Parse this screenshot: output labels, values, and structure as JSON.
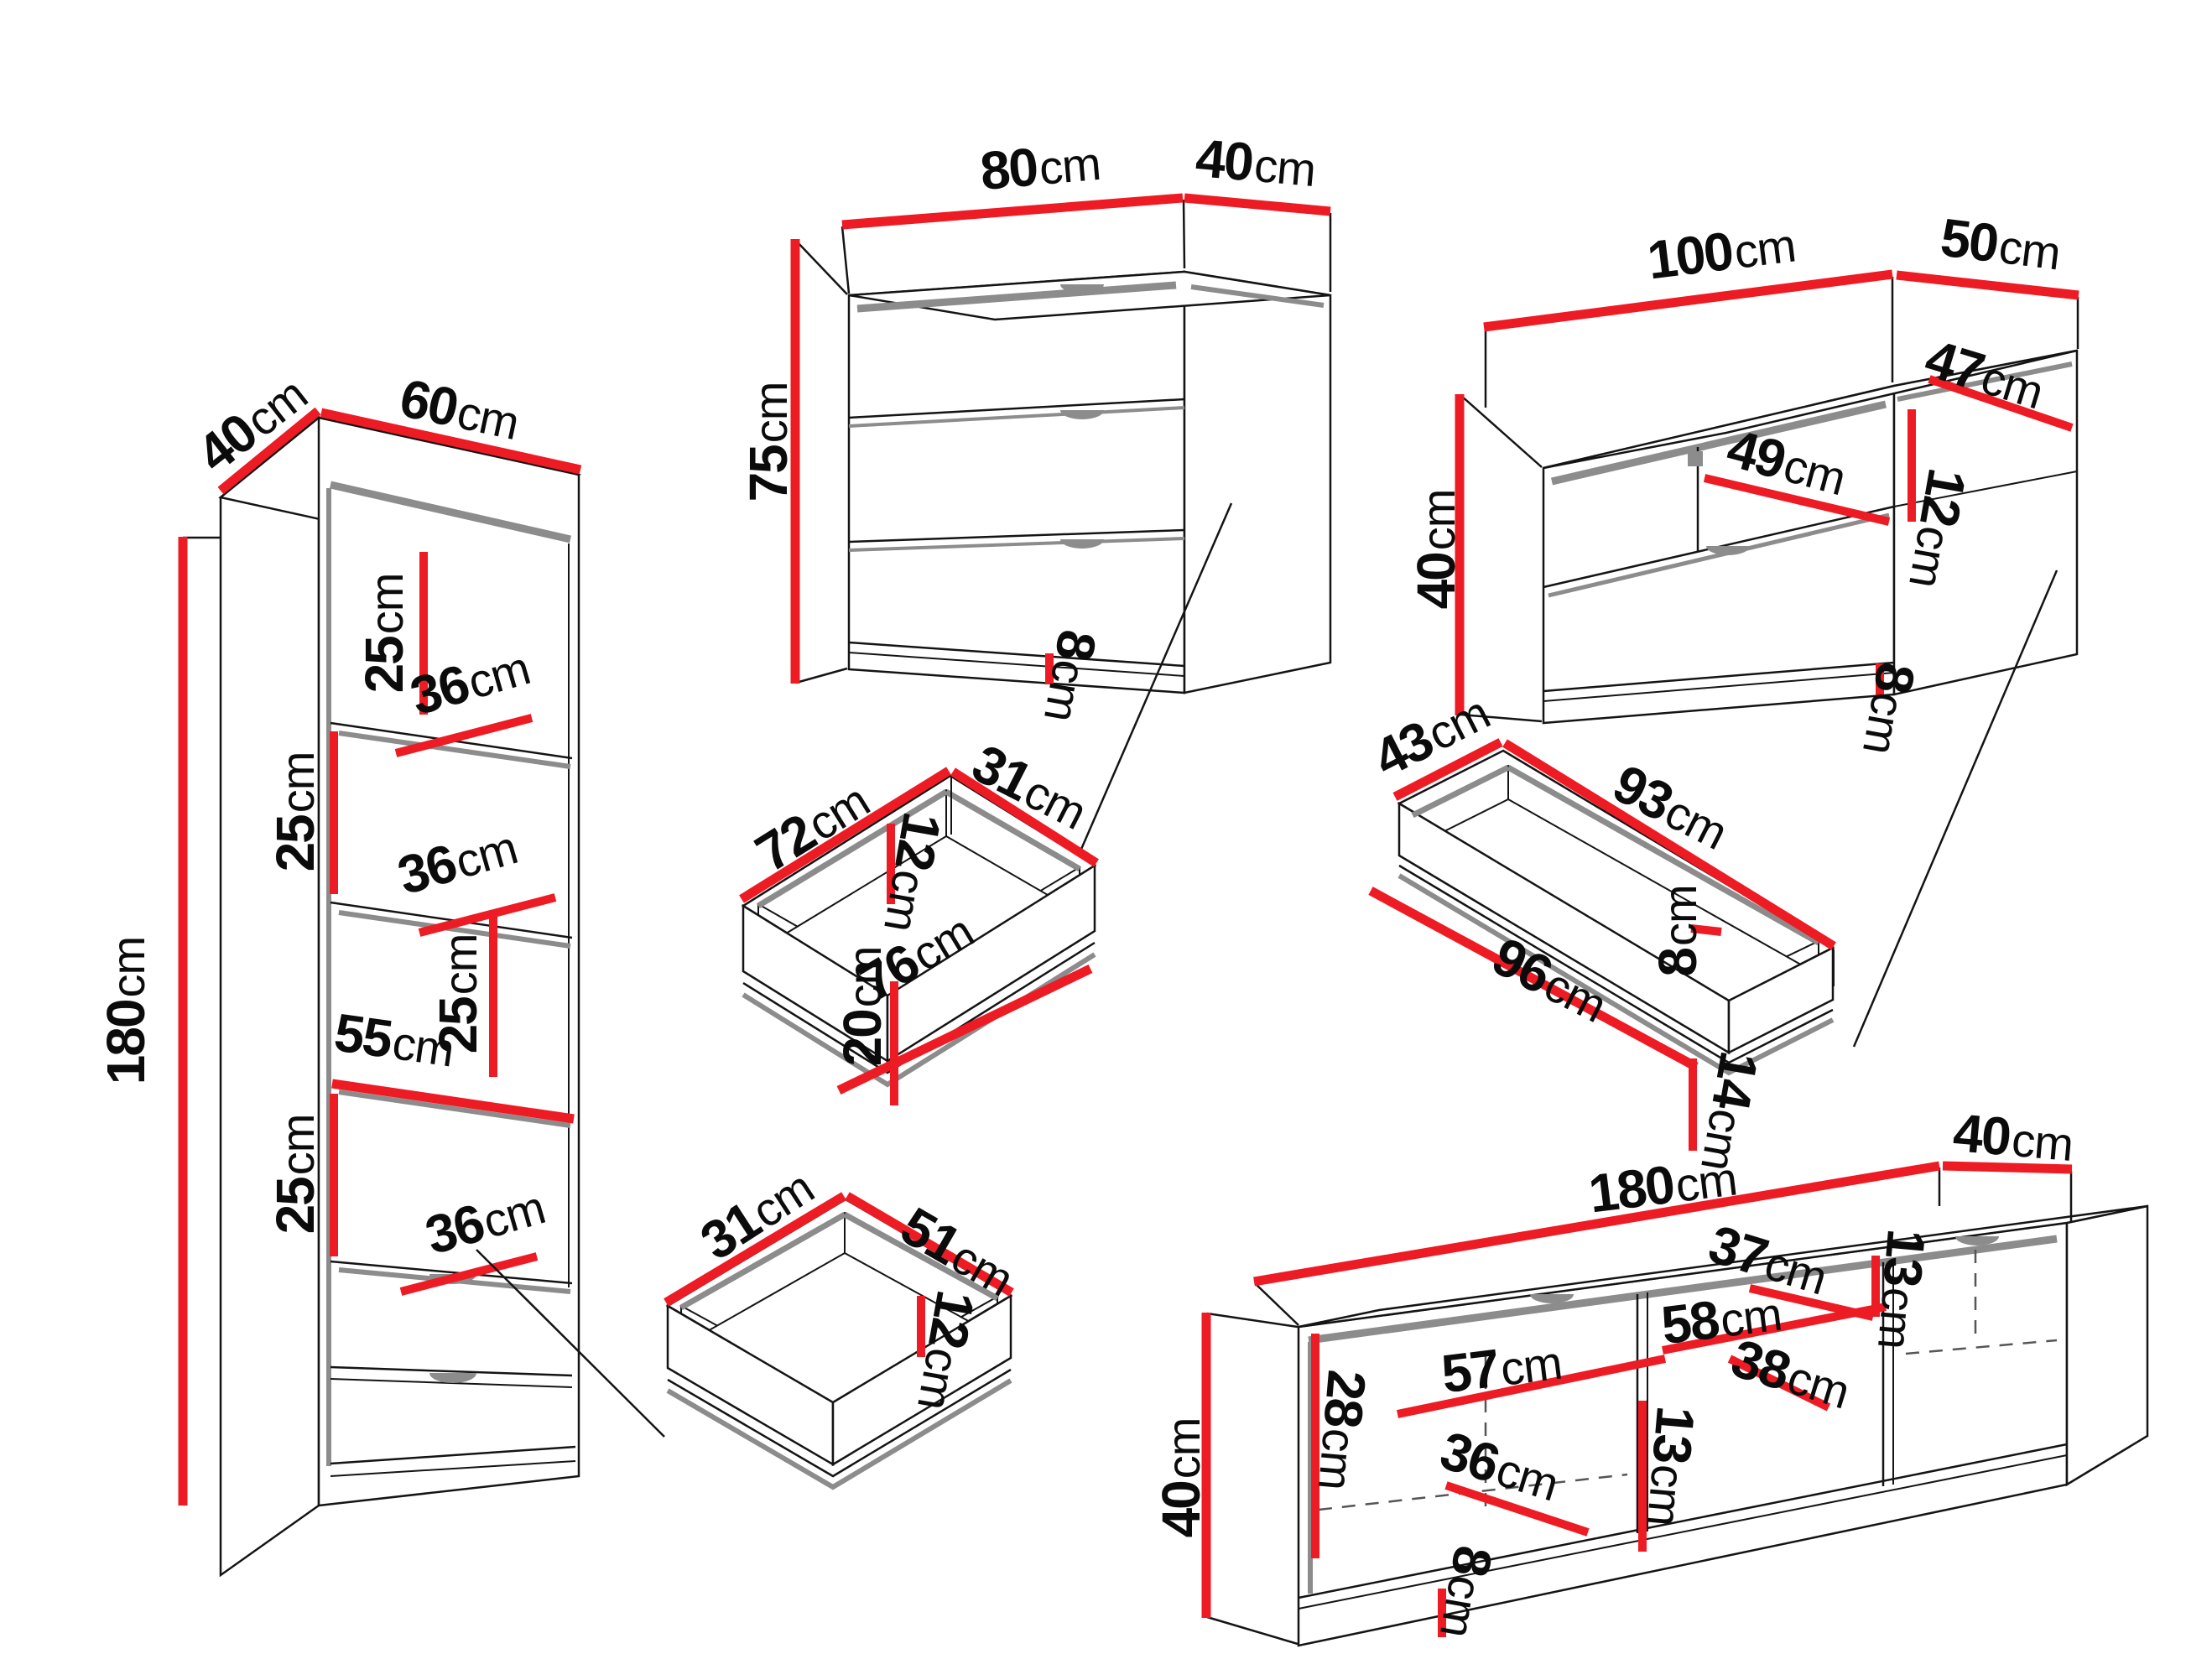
{
  "diagram_title": "Furniture dimensions diagram",
  "units": "cm",
  "colors": {
    "dimension_red": "#ed1c24",
    "shadow_gray": "#8c8c8c",
    "outline_black": "#141414",
    "background": "#ffffff"
  },
  "pieces": {
    "bookcase": {
      "name": "tall bookcase with drawers",
      "labels": {
        "depth": {
          "num": "40",
          "unit": "cm"
        },
        "width": {
          "num": "60",
          "unit": "cm"
        },
        "height": {
          "num": "180",
          "unit": "cm"
        },
        "c1": {
          "num": "25",
          "unit": "cm"
        },
        "s1": {
          "num": "36",
          "unit": "cm"
        },
        "c2": {
          "num": "25",
          "unit": "cm"
        },
        "s2": {
          "num": "36",
          "unit": "cm"
        },
        "c3": {
          "num": "25",
          "unit": "cm"
        },
        "shelf_width": {
          "num": "55",
          "unit": "cm"
        },
        "c4": {
          "num": "25",
          "unit": "cm"
        },
        "s3": {
          "num": "36",
          "unit": "cm"
        }
      }
    },
    "chest": {
      "name": "chest of drawers",
      "labels": {
        "width": {
          "num": "80",
          "unit": "cm"
        },
        "depth": {
          "num": "40",
          "unit": "cm"
        },
        "height": {
          "num": "75",
          "unit": "cm"
        },
        "plinth": {
          "num": "8",
          "unit": "cm"
        }
      }
    },
    "drawer_chest": {
      "name": "chest drawer box",
      "labels": {
        "width": {
          "num": "72",
          "unit": "cm"
        },
        "depth": {
          "num": "31",
          "unit": "cm"
        },
        "inner_height": {
          "num": "12",
          "unit": "cm"
        },
        "front_width": {
          "num": "76",
          "unit": "cm"
        },
        "front_height": {
          "num": "20",
          "unit": "cm"
        }
      }
    },
    "tv_small": {
      "name": "TV cabinet 100",
      "labels": {
        "width": {
          "num": "100",
          "unit": "cm"
        },
        "depth": {
          "num": "50",
          "unit": "cm"
        },
        "height": {
          "num": "40",
          "unit": "cm"
        },
        "shelf_depth": {
          "num": "47",
          "unit": "cm"
        },
        "shelf_width": {
          "num": "49",
          "unit": "cm"
        },
        "opening": {
          "num": "12",
          "unit": "cm"
        },
        "plinth": {
          "num": "8",
          "unit": "cm"
        }
      }
    },
    "drawer_tv_small": {
      "name": "TV cabinet drawer box",
      "labels": {
        "depth": {
          "num": "43",
          "unit": "cm"
        },
        "width": {
          "num": "93",
          "unit": "cm"
        },
        "inner_height": {
          "num": "8",
          "unit": "cm"
        },
        "front_width": {
          "num": "96",
          "unit": "cm"
        },
        "front_height": {
          "num": "14",
          "unit": "cm"
        }
      }
    },
    "drawer_bookcase": {
      "name": "bookcase drawer box",
      "labels": {
        "depth": {
          "num": "31",
          "unit": "cm"
        },
        "width": {
          "num": "51",
          "unit": "cm"
        },
        "inner_height": {
          "num": "12",
          "unit": "cm"
        }
      }
    },
    "tv_large": {
      "name": "TV stand 180",
      "labels": {
        "width": {
          "num": "180",
          "unit": "cm"
        },
        "depth": {
          "num": "40",
          "unit": "cm"
        },
        "height": {
          "num": "40",
          "unit": "cm"
        },
        "left_opening": {
          "num": "28",
          "unit": "cm"
        },
        "shelf_left": {
          "num": "57",
          "unit": "cm"
        },
        "shelf_left_depth": {
          "num": "36",
          "unit": "cm"
        },
        "plinth": {
          "num": "8",
          "unit": "cm"
        },
        "mid_opening": {
          "num": "13",
          "unit": "cm"
        },
        "shelf_mid": {
          "num": "58",
          "unit": "cm"
        },
        "shelf_mid_depth": {
          "num": "38",
          "unit": "cm"
        },
        "shelf_right": {
          "num": "37",
          "unit": "cm"
        },
        "right_opening": {
          "num": "13",
          "unit": "cm"
        }
      }
    }
  }
}
